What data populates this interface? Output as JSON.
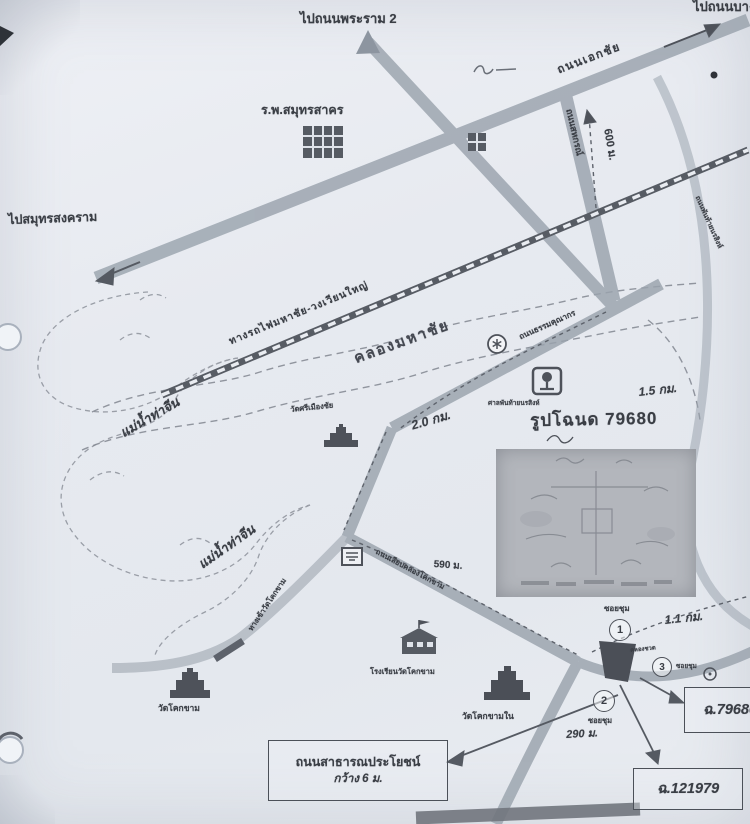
{
  "palette": {
    "paper": "#e8ebf1",
    "ink": "#3a3e45",
    "road": "#9aa3ad",
    "rail": "#575c64",
    "dark_plot": "#4b4f57"
  },
  "destinations": {
    "rama2": "ไปถนนพระราม 2",
    "bang_bon": "ไปถนนบางบอน",
    "samut_songkhram": "ไปสมุทรสงคราม"
  },
  "roads": {
    "ekachai": "ถนนเอกชัย",
    "sahakorn": "ถนนสหกรณ์",
    "thammakunakorn": "ถนนธรรมคุณากร",
    "liab_khlong": "ถนนเลียบคลองโคกขาม",
    "wat_access": "ทางเข้าวัดโคกขาม",
    "panthai": "ถนนพันท้ายนรสิงห์"
  },
  "railway": {
    "label": "ทางรถไฟมหาชัย-วงเวียนใหญ่"
  },
  "waterways": {
    "canal": "คลองมหาชัย",
    "river_upper": "แม่น้ำท่าจีน",
    "river_lower": "แม่น้ำท่าจีน"
  },
  "places": {
    "hospital": "ร.พ.สมุทรสาคร",
    "wat_si_mueang": "วัดศรีเมืองชัย",
    "wat_khok_kham": "วัดโคกขาม",
    "wat_khok_kham_nai": "วัดโคกขามใน",
    "school": "โรงเรียนวัดโคกขาม",
    "shrine": "ศาลพันท้ายนรสิงห์"
  },
  "distances": {
    "d600m": "600 ม.",
    "d2_0km": "2.0 กม.",
    "d1_5km": "1.5 กม.",
    "d590m": "590 ม.",
    "d1_1km": "1.1 กม.",
    "d290m": "290 ม."
  },
  "markers": {
    "n1": "1",
    "n2": "2",
    "n3": "3",
    "soi1": "ซอยชุม",
    "soi2": "ซอยชุม",
    "soi3": "คลองชวด",
    "soi_right": "ซอยชุม"
  },
  "deed": {
    "title": "รูปโฉนด 79680",
    "ref1": "ฉ.79680",
    "ref2": "ฉ.121979"
  },
  "callouts": {
    "public_road_line1": "ถนนสาธารณประโยชน์",
    "public_road_line2": "กว้าง 6 ม."
  }
}
